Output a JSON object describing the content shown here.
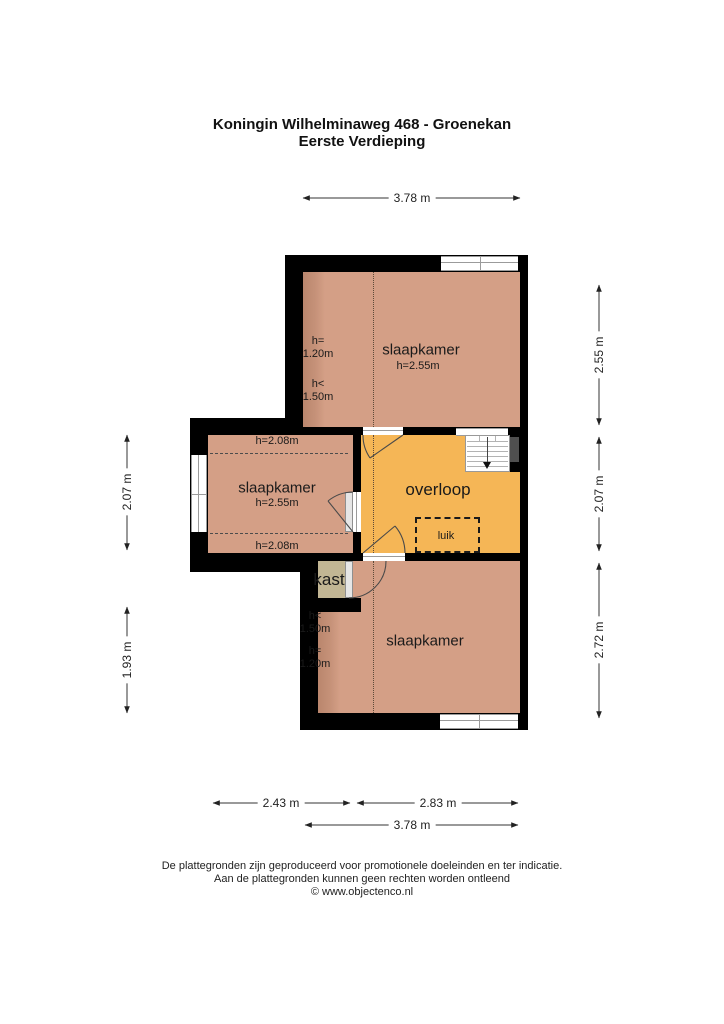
{
  "title": {
    "line1": "Koningin Wilhelminaweg 468 - Groenekan",
    "line2": "Eerste Verdieping"
  },
  "colors": {
    "floor": "#d49f86",
    "landing": "#f5b656",
    "closet": "#c2b694",
    "wall": "#000000"
  },
  "rooms": {
    "bedroom_top": {
      "label": "slaapkamer",
      "ceiling": "h=2.55m",
      "slope_high": "h=\n1.20m",
      "slope_low": "h<\n1.50m"
    },
    "bedroom_left": {
      "label": "slaapkamer",
      "ceiling": "h=2.55m",
      "edge_top": "h=2.08m",
      "edge_bottom": "h=2.08m"
    },
    "bedroom_bottom": {
      "label": "slaapkamer",
      "slope_low": "h<\n1.50m",
      "slope_high": "h=\n1.20m"
    },
    "landing": {
      "label": "overloop"
    },
    "closet": {
      "label": "kast"
    },
    "hatch": {
      "label": "luik"
    }
  },
  "dimensions": {
    "top_total": "3.78 m",
    "right": [
      "2.55 m",
      "2.07 m",
      "2.72 m"
    ],
    "left": [
      "2.07 m",
      "1.93 m"
    ],
    "bottom": [
      "2.43 m",
      "2.83 m"
    ],
    "bottom_total": "3.78 m"
  },
  "footer": {
    "line1": "De plattegronden zijn geproduceerd voor promotionele doeleinden en ter indicatie.",
    "line2": "Aan de plattegronden kunnen geen rechten worden ontleend",
    "line3": "© www.objectenco.nl"
  }
}
